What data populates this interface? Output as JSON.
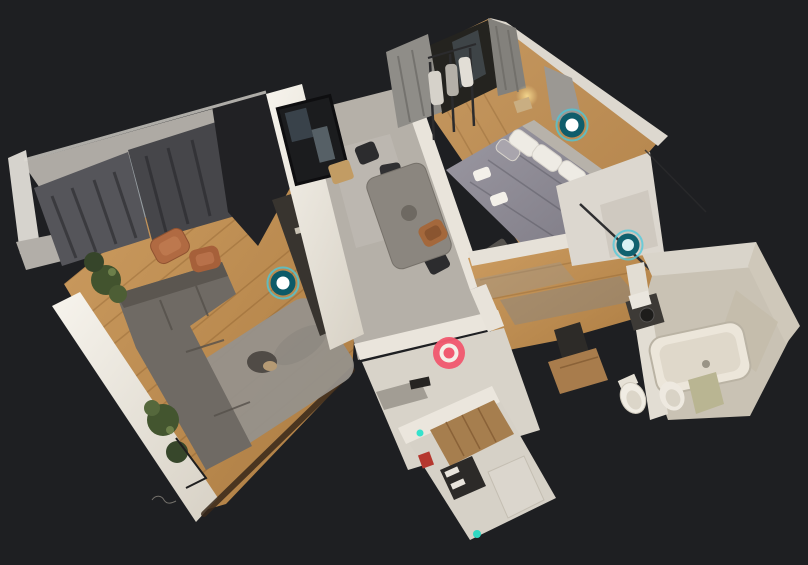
{
  "app": {
    "type": "3d-virtual-tour-viewer",
    "view_mode": "dollhouse",
    "background_color": "#1e1f22"
  },
  "scene": {
    "description": "Top-down 3D dollhouse scan of a small apartment tilted diagonally on a dark canvas",
    "rooms": [
      {
        "name": "living-room",
        "floor": "wood",
        "features": [
          "gray corner sofa",
          "gray shag rug with cat tree",
          "two rust leather armchairs",
          "potted plants",
          "dark curtains over windows",
          "open kitchen counter"
        ]
      },
      {
        "name": "kitchen-dining",
        "floor": "gray-tile",
        "features": [
          "gray dining table",
          "black chairs",
          "wood chair",
          "brown leather chair",
          "dark framed window in wall"
        ]
      },
      {
        "name": "bedroom",
        "floor": "wood",
        "features": [
          "double bed with gray duvet",
          "white pillows",
          "clothes rail with hanging clothes",
          "balcony door with gray curtains",
          "warm bedside lamp"
        ]
      },
      {
        "name": "hallway",
        "floor": "wood",
        "features": [
          "white walls",
          "closet with mirror rail",
          "doorways"
        ]
      },
      {
        "name": "bathroom",
        "floor": "beige-tile",
        "features": [
          "bathtub",
          "toilet",
          "bidet-sink",
          "washing machine"
        ]
      },
      {
        "name": "utility-room",
        "floor": "light-tile",
        "features": [
          "wood wardrobe",
          "dark mat with white pillows",
          "white appliance",
          "teal indicator lights",
          "small red object"
        ]
      }
    ],
    "palette": {
      "background": "#1e1f22",
      "wood_floor": "#c49456",
      "wood_floor_dark": "#a8783e",
      "wall_light": "#f2eee6",
      "wall_shade": "#d8d2c6",
      "tile_gray": "#b5b0a8",
      "tile_light": "#d6d1c7",
      "bath_floor": "#c9c2b4",
      "sofa_gray": "#6f6a64",
      "bed_gray": "#908d97",
      "curtain_dark": "#47474b",
      "rug_gray": "#96918b"
    }
  },
  "viewer": {
    "waypoints": [
      {
        "id": "living-room",
        "x": 283,
        "y": 283,
        "transform": "translate(283,283)",
        "accent_color": "#4cc7d8",
        "ring_color": "#0d5a68",
        "center_color": "#ffffff"
      },
      {
        "id": "bedroom",
        "x": 572,
        "y": 125,
        "transform": "translate(572,125)",
        "accent_color": "#4cc7d8",
        "ring_color": "#0f5d6b",
        "center_color": "#ffffff"
      },
      {
        "id": "hallway-closet",
        "x": 628,
        "y": 245,
        "transform": "translate(628,245)",
        "accent_color": "#52cbdc",
        "ring_color": "#11616f",
        "center_color": "#d9f1f4"
      }
    ],
    "current_position": {
      "id": "current-position",
      "x": 449,
      "y": 353,
      "transform": "translate(449,353)",
      "color": "#f15a70",
      "ring_color": "#f4efe7"
    }
  }
}
